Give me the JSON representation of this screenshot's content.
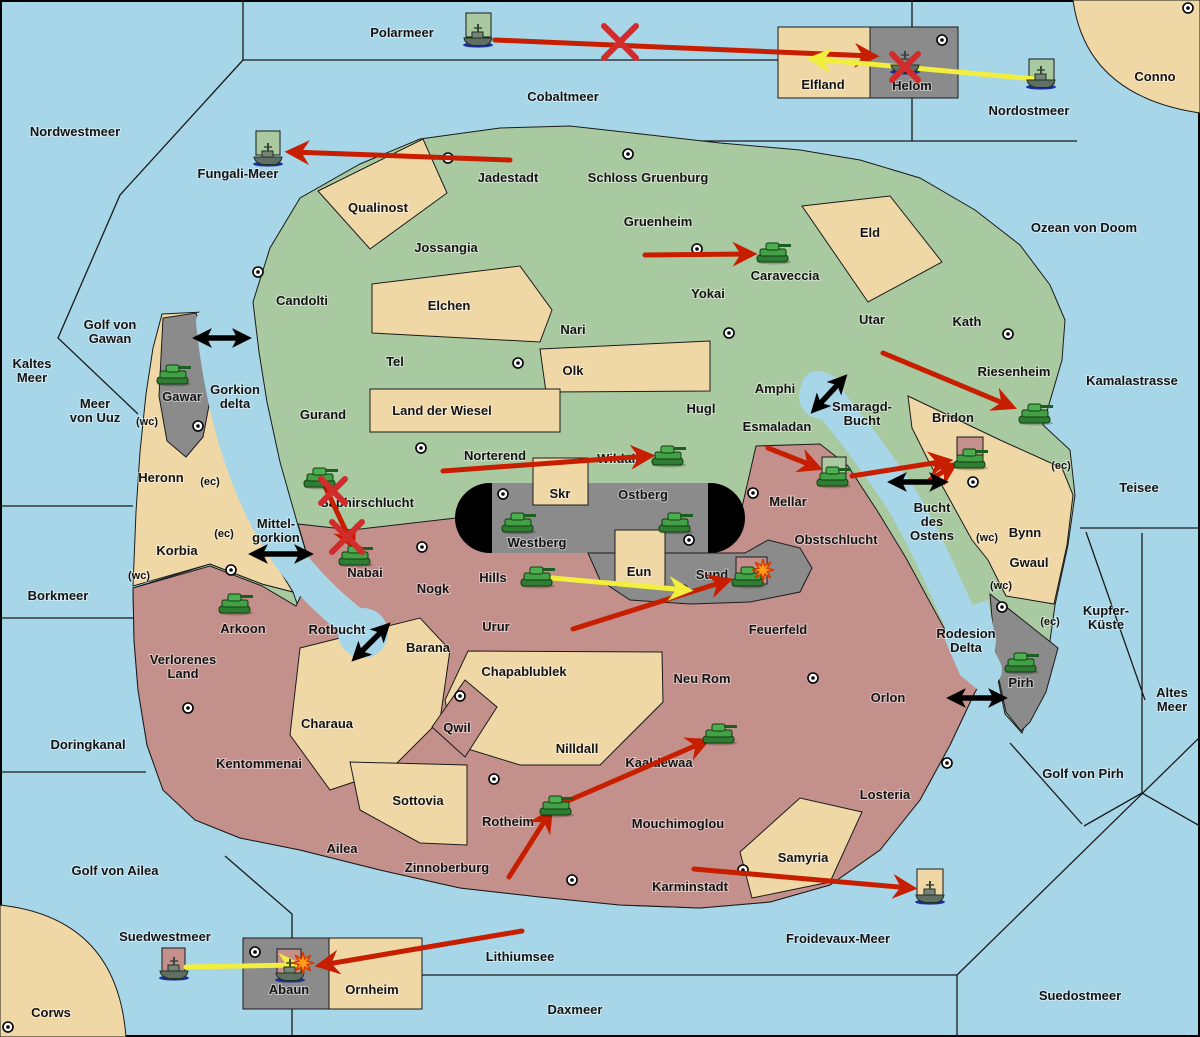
{
  "colors": {
    "sea": "#A7D6E8",
    "land_green": "#A9C9A1",
    "land_tan": "#EFD8A6",
    "land_red": "#C4908B",
    "land_gray": "#8B8B8B",
    "border": "#1B1B1B",
    "move_arrow": "#C81E00",
    "support_arrow": "#F2EE3E",
    "strait_arrow": "#000000",
    "failed_x": "#D22B2B",
    "explosion": "#FF9C1B",
    "tank": "#43A047",
    "ship": "#5F6F63"
  },
  "labels": {
    "sea": [
      {
        "text": "Polarmeer",
        "x": 402,
        "y": 37
      },
      {
        "text": "Nordwestmeer",
        "x": 75,
        "y": 136
      },
      {
        "text": "Cobaltmeer",
        "x": 563,
        "y": 101
      },
      {
        "text": "Nordostmeer",
        "x": 1029,
        "y": 115
      },
      {
        "text": "Ozean von Doom",
        "x": 1084,
        "y": 232
      },
      {
        "text": "Kamalastrasse",
        "x": 1132,
        "y": 385
      },
      {
        "text": "Teisee",
        "x": 1139,
        "y": 492
      },
      {
        "lines": [
          "Kaltes",
          "Meer"
        ],
        "x": 32,
        "y": 368
      },
      {
        "lines": [
          "Golf von",
          "Gawan"
        ],
        "x": 110,
        "y": 329
      },
      {
        "lines": [
          "Meer",
          "von Uuz"
        ],
        "x": 95,
        "y": 408
      },
      {
        "text": "Fungali-Meer",
        "x": 238,
        "y": 178
      },
      {
        "lines": [
          "Gorkion",
          "delta"
        ],
        "x": 235,
        "y": 394
      },
      {
        "lines": [
          "Smaragd-",
          "Bucht"
        ],
        "x": 862,
        "y": 411
      },
      {
        "lines": [
          "Bucht",
          "des",
          "Ostens"
        ],
        "x": 932,
        "y": 512
      },
      {
        "lines": [
          "Mittel-",
          "gorkion"
        ],
        "x": 276,
        "y": 528
      },
      {
        "text": "Borkmeer",
        "x": 58,
        "y": 600
      },
      {
        "lines": [
          "Kupfer-",
          "Küste"
        ],
        "x": 1106,
        "y": 615
      },
      {
        "lines": [
          "Rodesion",
          "Delta"
        ],
        "x": 966,
        "y": 638
      },
      {
        "lines": [
          "Altes",
          "Meer"
        ],
        "x": 1172,
        "y": 697
      },
      {
        "text": "Rotbucht",
        "x": 337,
        "y": 634
      },
      {
        "text": "Doringkanal",
        "x": 88,
        "y": 749
      },
      {
        "text": "Golf von Pirh",
        "x": 1083,
        "y": 778
      },
      {
        "text": "Golf von Ailea",
        "x": 115,
        "y": 875
      },
      {
        "text": "Froidevaux-Meer",
        "x": 838,
        "y": 943
      },
      {
        "text": "Suedwestmeer",
        "x": 165,
        "y": 941
      },
      {
        "text": "Lithiumsee",
        "x": 520,
        "y": 961
      },
      {
        "text": "Daxmeer",
        "x": 575,
        "y": 1014
      },
      {
        "text": "Suedostmeer",
        "x": 1080,
        "y": 1000
      }
    ],
    "land": [
      {
        "text": "Elfland",
        "x": 823,
        "y": 89
      },
      {
        "text": "Helom",
        "x": 912,
        "y": 90
      },
      {
        "text": "Conno",
        "x": 1155,
        "y": 81
      },
      {
        "text": "Jadestadt",
        "x": 508,
        "y": 182
      },
      {
        "text": "Schloss Gruenburg",
        "x": 648,
        "y": 182
      },
      {
        "text": "Qualinost",
        "x": 378,
        "y": 212
      },
      {
        "text": "Jossangia",
        "x": 446,
        "y": 252
      },
      {
        "text": "Gruenheim",
        "x": 658,
        "y": 226
      },
      {
        "text": "Caraveccia",
        "x": 785,
        "y": 280
      },
      {
        "text": "Yokai",
        "x": 708,
        "y": 298
      },
      {
        "text": "Eld",
        "x": 870,
        "y": 237
      },
      {
        "text": "Candolti",
        "x": 302,
        "y": 305
      },
      {
        "text": "Elchen",
        "x": 449,
        "y": 310
      },
      {
        "text": "Nari",
        "x": 573,
        "y": 334
      },
      {
        "text": "Tel",
        "x": 395,
        "y": 366
      },
      {
        "text": "Olk",
        "x": 573,
        "y": 375
      },
      {
        "text": "Gurand",
        "x": 323,
        "y": 419
      },
      {
        "text": "Land der Wiesel",
        "x": 442,
        "y": 415
      },
      {
        "text": "Hugl",
        "x": 701,
        "y": 413
      },
      {
        "text": "Amphi",
        "x": 775,
        "y": 393
      },
      {
        "text": "Esmaladan",
        "x": 777,
        "y": 431
      },
      {
        "text": "Utar",
        "x": 872,
        "y": 324
      },
      {
        "text": "Kath",
        "x": 967,
        "y": 326
      },
      {
        "text": "Riesenheim",
        "x": 1014,
        "y": 376
      },
      {
        "text": "Bridon",
        "x": 953,
        "y": 422
      },
      {
        "text": "Norterend",
        "x": 495,
        "y": 460
      },
      {
        "text": "Wildall",
        "x": 618,
        "y": 463
      },
      {
        "text": "Skr",
        "x": 560,
        "y": 498
      },
      {
        "text": "Ostberg",
        "x": 643,
        "y": 499
      },
      {
        "text": "Westberg",
        "x": 537,
        "y": 547
      },
      {
        "text": "Saphirschlucht",
        "x": 367,
        "y": 507
      },
      {
        "text": "Mellar",
        "x": 788,
        "y": 506
      },
      {
        "text": "Obstschlucht",
        "x": 836,
        "y": 544
      },
      {
        "text": "Nabai",
        "x": 365,
        "y": 577
      },
      {
        "text": "Bynn",
        "x": 1025,
        "y": 537
      },
      {
        "text": "Gwaul",
        "x": 1029,
        "y": 567
      },
      {
        "text": "Hills",
        "x": 493,
        "y": 582
      },
      {
        "text": "Eun",
        "x": 639,
        "y": 576
      },
      {
        "text": "Sund",
        "x": 712,
        "y": 579
      },
      {
        "text": "Nogk",
        "x": 433,
        "y": 593
      },
      {
        "text": "Urur",
        "x": 496,
        "y": 631
      },
      {
        "text": "Feuerfeld",
        "x": 778,
        "y": 634
      },
      {
        "text": "Heronn",
        "x": 161,
        "y": 482
      },
      {
        "text": "Korbia",
        "x": 177,
        "y": 555
      },
      {
        "text": "Gawar",
        "x": 182,
        "y": 401
      },
      {
        "text": "Arkoon",
        "x": 243,
        "y": 633
      },
      {
        "lines": [
          "Verlorenes",
          "Land"
        ],
        "x": 183,
        "y": 664
      },
      {
        "text": "Barana",
        "x": 428,
        "y": 652
      },
      {
        "text": "Chapablublek",
        "x": 524,
        "y": 676
      },
      {
        "text": "Neu Rom",
        "x": 702,
        "y": 683
      },
      {
        "text": "Qwil",
        "x": 457,
        "y": 732
      },
      {
        "text": "Nilldall",
        "x": 577,
        "y": 753
      },
      {
        "text": "Kaaldewaa",
        "x": 659,
        "y": 767
      },
      {
        "text": "Orlon",
        "x": 888,
        "y": 702
      },
      {
        "text": "Charaua",
        "x": 327,
        "y": 728
      },
      {
        "text": "Kentommenai",
        "x": 259,
        "y": 768
      },
      {
        "text": "Sottovia",
        "x": 418,
        "y": 805
      },
      {
        "text": "Rotheim",
        "x": 508,
        "y": 826
      },
      {
        "text": "Mouchimoglou",
        "x": 678,
        "y": 828
      },
      {
        "text": "Losteria",
        "x": 885,
        "y": 799
      },
      {
        "text": "Ailea",
        "x": 342,
        "y": 853
      },
      {
        "text": "Zinnoberburg",
        "x": 447,
        "y": 872
      },
      {
        "text": "Karminstadt",
        "x": 690,
        "y": 891
      },
      {
        "text": "Samyria",
        "x": 803,
        "y": 862
      },
      {
        "text": "Pirh",
        "x": 1021,
        "y": 687
      },
      {
        "text": "Abaun",
        "x": 289,
        "y": 994
      },
      {
        "text": "Ornheim",
        "x": 372,
        "y": 994
      },
      {
        "text": "Corws",
        "x": 51,
        "y": 1017
      }
    ],
    "coast_tags": [
      {
        "text": "(wc)",
        "x": 147,
        "y": 425
      },
      {
        "text": "(ec)",
        "x": 210,
        "y": 485
      },
      {
        "text": "(ec)",
        "x": 224,
        "y": 537
      },
      {
        "text": "(wc)",
        "x": 139,
        "y": 579
      },
      {
        "text": "(ec)",
        "x": 1061,
        "y": 469
      },
      {
        "text": "(wc)",
        "x": 987,
        "y": 541
      },
      {
        "text": "(wc)",
        "x": 1001,
        "y": 589
      },
      {
        "text": "(ec)",
        "x": 1050,
        "y": 625
      }
    ]
  },
  "supply_centers": [
    [
      942,
      40
    ],
    [
      1188,
      8
    ],
    [
      448,
      158
    ],
    [
      628,
      154
    ],
    [
      258,
      272
    ],
    [
      697,
      249
    ],
    [
      1008,
      334
    ],
    [
      729,
      333
    ],
    [
      518,
      363
    ],
    [
      198,
      426
    ],
    [
      421,
      448
    ],
    [
      753,
      493
    ],
    [
      503,
      494
    ],
    [
      689,
      540
    ],
    [
      973,
      482
    ],
    [
      231,
      570
    ],
    [
      422,
      547
    ],
    [
      683,
      590
    ],
    [
      188,
      708
    ],
    [
      460,
      696
    ],
    [
      813,
      678
    ],
    [
      1002,
      607
    ],
    [
      494,
      779
    ],
    [
      572,
      880
    ],
    [
      947,
      763
    ],
    [
      743,
      870
    ],
    [
      255,
      952
    ],
    [
      8,
      1027
    ]
  ],
  "units": [
    {
      "type": "tank",
      "territory": "Caraveccia",
      "x": 773,
      "y": 253,
      "tile": null
    },
    {
      "type": "tank",
      "territory": "Gawar",
      "x": 173,
      "y": 375,
      "tile": null
    },
    {
      "type": "tank",
      "territory": "Wildall",
      "x": 668,
      "y": 456,
      "tile": null
    },
    {
      "type": "tank",
      "territory": "Saphirschlucht",
      "x": 320,
      "y": 478,
      "tile": null
    },
    {
      "type": "tank",
      "territory": "Nabai",
      "x": 355,
      "y": 556,
      "tile": null
    },
    {
      "type": "tank",
      "territory": "Westberg",
      "x": 518,
      "y": 523,
      "tile": null
    },
    {
      "type": "tank",
      "territory": "Ostberg",
      "x": 675,
      "y": 523,
      "tile": null
    },
    {
      "type": "tank",
      "territory": "Mellar",
      "x": 833,
      "y": 477,
      "tile": {
        "x": 822,
        "y": 457,
        "w": 24,
        "h": 22,
        "color": "#A9C9A1"
      }
    },
    {
      "type": "tank",
      "territory": "Riesenheim",
      "x": 1035,
      "y": 414,
      "tile": null
    },
    {
      "type": "tank",
      "territory": "Bridon",
      "x": 970,
      "y": 459,
      "tile": {
        "x": 957,
        "y": 437,
        "w": 26,
        "h": 29,
        "color": "#C4908B"
      }
    },
    {
      "type": "tank",
      "territory": "Hills",
      "x": 537,
      "y": 577,
      "tile": null
    },
    {
      "type": "tank",
      "territory": "Sund",
      "x": 748,
      "y": 577,
      "tile": {
        "x": 736,
        "y": 557,
        "w": 31,
        "h": 27,
        "color": "#C4908B"
      }
    },
    {
      "type": "tank",
      "territory": "Arkoon",
      "x": 235,
      "y": 604,
      "tile": null
    },
    {
      "type": "tank",
      "territory": "Kaaldewaa",
      "x": 719,
      "y": 734,
      "tile": null
    },
    {
      "type": "tank",
      "territory": "Rotheim",
      "x": 556,
      "y": 806,
      "tile": null
    },
    {
      "type": "tank",
      "territory": "Pirh",
      "x": 1021,
      "y": 663,
      "tile": null
    },
    {
      "type": "ship",
      "territory": "Polarmeer",
      "x": 478,
      "y": 36,
      "tile": {
        "x": 466,
        "y": 13,
        "w": 25,
        "h": 24,
        "color": "#A9C9A1"
      }
    },
    {
      "type": "ship",
      "territory": "Helom",
      "x": 905,
      "y": 63,
      "tile": null
    },
    {
      "type": "ship",
      "territory": "Nordostmeer",
      "x": 1041,
      "y": 78,
      "tile": {
        "x": 1029,
        "y": 59,
        "w": 25,
        "h": 25,
        "color": "#A9C9A1"
      }
    },
    {
      "type": "ship",
      "territory": "Fungali-Meer",
      "x": 268,
      "y": 155,
      "tile": {
        "x": 256,
        "y": 131,
        "w": 24,
        "h": 24,
        "color": "#A9C9A1"
      }
    },
    {
      "type": "ship",
      "territory": "Froidevaux-Meer",
      "x": 930,
      "y": 893,
      "tile": {
        "x": 917,
        "y": 869,
        "w": 26,
        "h": 26,
        "color": "#EFD8A6"
      }
    },
    {
      "type": "ship",
      "territory": "Suedwestmeer",
      "x": 174,
      "y": 969,
      "tile": {
        "x": 162,
        "y": 948,
        "w": 23,
        "h": 25,
        "color": "#C4908B"
      }
    },
    {
      "type": "ship",
      "territory": "Abaun",
      "x": 290,
      "y": 971,
      "tile": {
        "x": 277,
        "y": 949,
        "w": 24,
        "h": 24,
        "color": "#C4908B"
      }
    }
  ],
  "orders": {
    "moves_red": [
      [
        495,
        40,
        872,
        56
      ],
      [
        510,
        160,
        292,
        152
      ],
      [
        645,
        255,
        750,
        254
      ],
      [
        443,
        471,
        648,
        456
      ],
      [
        883,
        353,
        1010,
        406
      ],
      [
        768,
        448,
        816,
        467
      ],
      [
        852,
        476,
        946,
        461
      ],
      [
        930,
        480,
        952,
        466
      ],
      [
        573,
        629,
        726,
        581
      ],
      [
        563,
        803,
        704,
        742
      ],
      [
        509,
        877,
        549,
        814
      ],
      [
        694,
        869,
        910,
        888
      ],
      [
        522,
        931,
        322,
        965
      ],
      [
        322,
        480,
        352,
        544
      ]
    ],
    "supports_yellow": [
      [
        1035,
        79,
        814,
        59
      ],
      [
        552,
        578,
        686,
        590
      ],
      [
        186,
        967,
        296,
        965
      ]
    ],
    "strait_links_black": [
      [
        200,
        338,
        244,
        338
      ],
      [
        256,
        554,
        306,
        554
      ],
      [
        816,
        408,
        842,
        380
      ],
      [
        895,
        482,
        941,
        482
      ],
      [
        357,
        656,
        385,
        628
      ],
      [
        954,
        698,
        1000,
        698
      ]
    ],
    "failed_x_marks": [
      {
        "x": 620,
        "y": 42,
        "r": 16
      },
      {
        "x": 905,
        "y": 67,
        "r": 13
      },
      {
        "x": 333,
        "y": 491,
        "r": 12
      },
      {
        "x": 347,
        "y": 537,
        "r": 15
      }
    ],
    "explosions": [
      {
        "x": 763,
        "y": 570
      },
      {
        "x": 303,
        "y": 963
      }
    ]
  }
}
